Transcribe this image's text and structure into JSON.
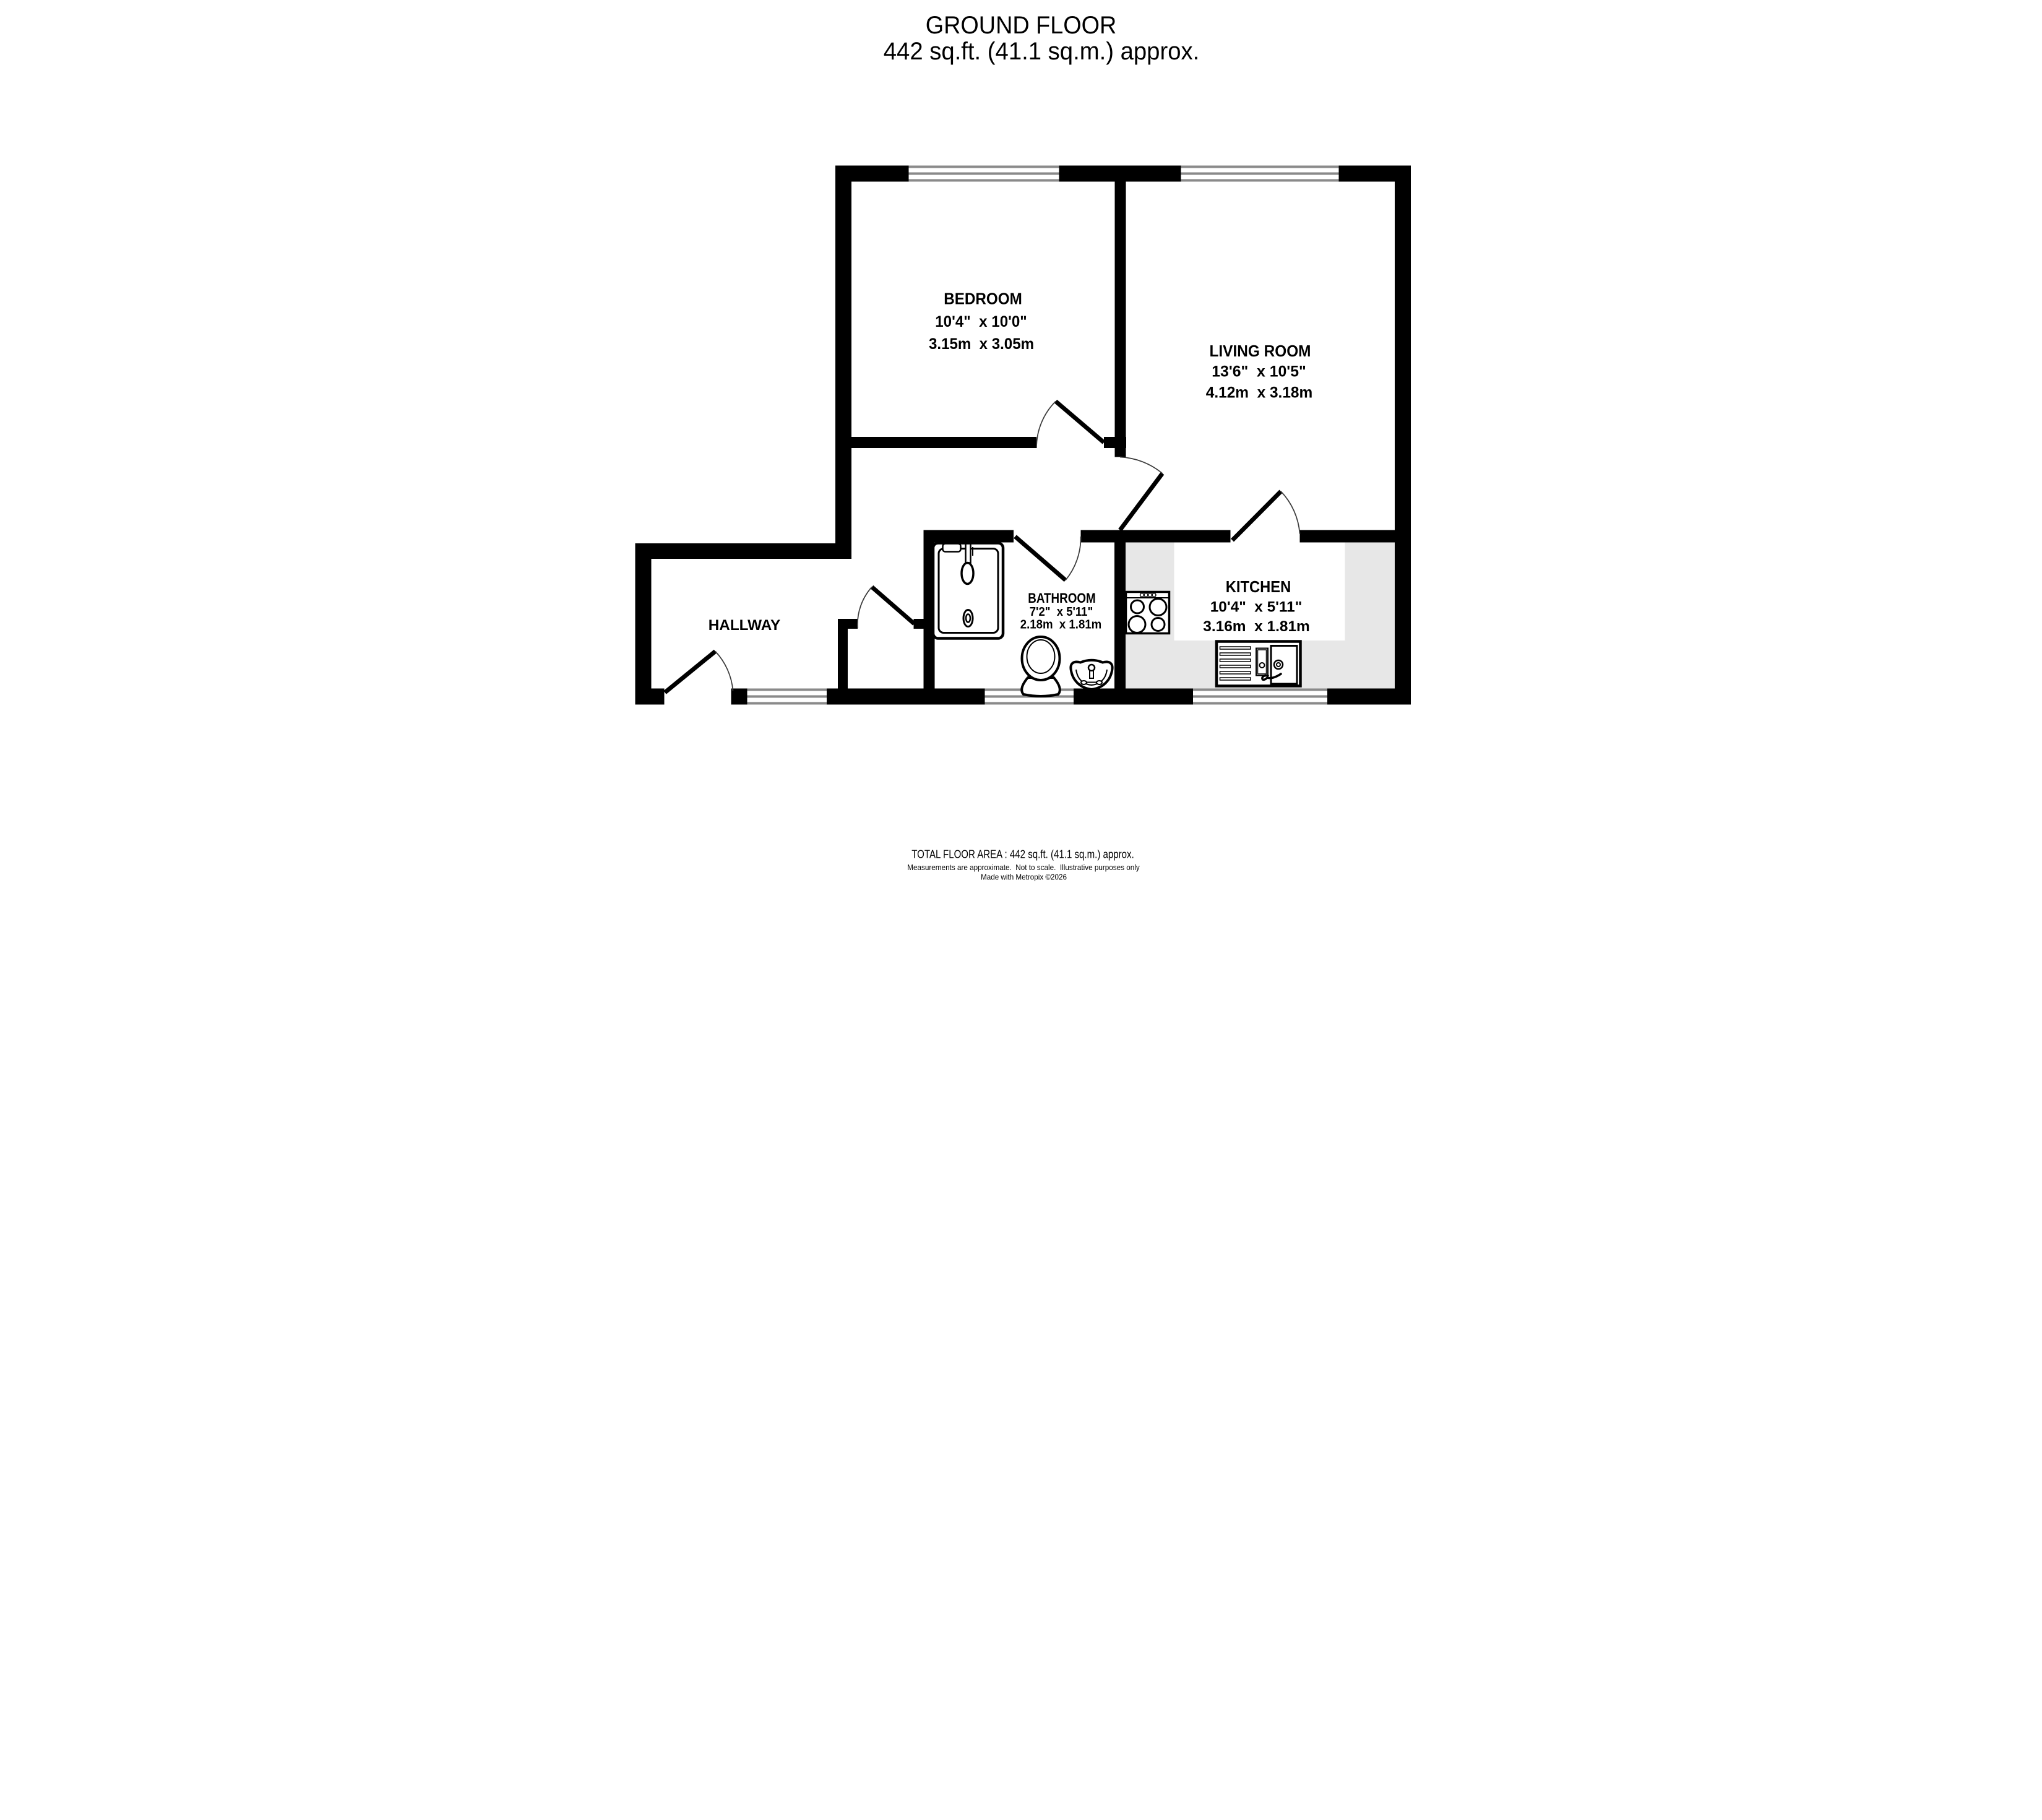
{
  "title": {
    "line1": "GROUND FLOOR",
    "line2": "442 sq.ft. (41.1 sq.m.) approx."
  },
  "rooms": {
    "bedroom": {
      "name": "BEDROOM",
      "imperial": "10'4\"  x 10'0\"",
      "metric": "3.15m  x 3.05m"
    },
    "living_room": {
      "name": "LIVING ROOM",
      "imperial": "13'6\"  x 10'5\"",
      "metric": "4.12m  x 3.18m"
    },
    "bathroom": {
      "name": "BATHROOM",
      "imperial": "7'2\"  x 5'11\"",
      "metric": "2.18m  x 1.81m"
    },
    "kitchen": {
      "name": "KITCHEN",
      "imperial": "10'4\"  x 5'11\"",
      "metric": "3.16m  x 1.81m"
    },
    "hallway": {
      "name": "HALLWAY"
    }
  },
  "footer": {
    "total_area": "TOTAL FLOOR AREA : 442 sq.ft. (41.1 sq.m.) approx.",
    "disclaimer": "Measurements are approximate.  Not to scale.  Illustrative purposes only",
    "credit": "Made with Metropix ©2026"
  },
  "colors": {
    "wall": "#000000",
    "window_line": "#8a8a8a",
    "kitchen_counter": "#e7e7e7",
    "background": "#ffffff"
  }
}
